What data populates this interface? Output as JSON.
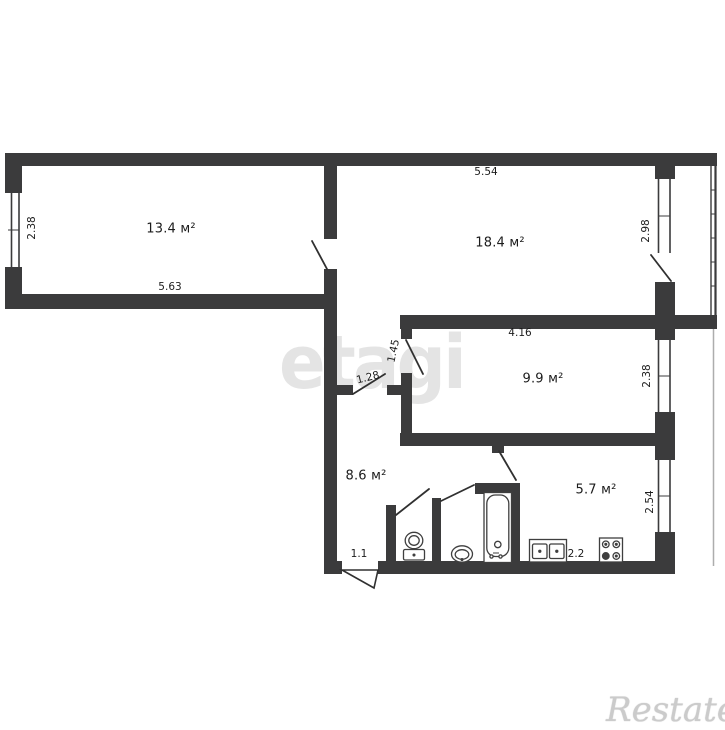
{
  "plan": {
    "rooms": [
      {
        "name": "living-room-1",
        "area": "13.4 м²"
      },
      {
        "name": "living-room-2",
        "area": "18.4 м²"
      },
      {
        "name": "bedroom",
        "area": "9.9 м²"
      },
      {
        "name": "hallway",
        "area": "8.6 м²"
      },
      {
        "name": "kitchen",
        "area": "5.7 м²"
      }
    ],
    "dimensions": [
      {
        "name": "room1-width",
        "value": "2.38"
      },
      {
        "name": "room1-length",
        "value": "5.63"
      },
      {
        "name": "room2-length",
        "value": "5.54"
      },
      {
        "name": "room2-width",
        "value": "2.98"
      },
      {
        "name": "room3-length",
        "value": "4.16"
      },
      {
        "name": "corridor-depth",
        "value": "1.45"
      },
      {
        "name": "corridor-width",
        "value": "1.28"
      },
      {
        "name": "room3-width",
        "value": "2.38"
      },
      {
        "name": "entry-width",
        "value": "1.1"
      },
      {
        "name": "kitchen-length",
        "value": "2.2"
      },
      {
        "name": "kitchen-width",
        "value": "2.54"
      }
    ],
    "fixtures": [
      "toilet",
      "washbasin",
      "bathtub",
      "kitchen-sink",
      "stove"
    ],
    "watermarks": {
      "center": "etagi",
      "bottom_right": "Restate"
    },
    "colors": {
      "wall": "#3b3b3c",
      "door_line": "#303030",
      "background": "#ffffff",
      "neighbor_balcony_line": "#adadad",
      "watermark_center": "#e4e4e4",
      "watermark_script": "#cbcbcb"
    }
  }
}
